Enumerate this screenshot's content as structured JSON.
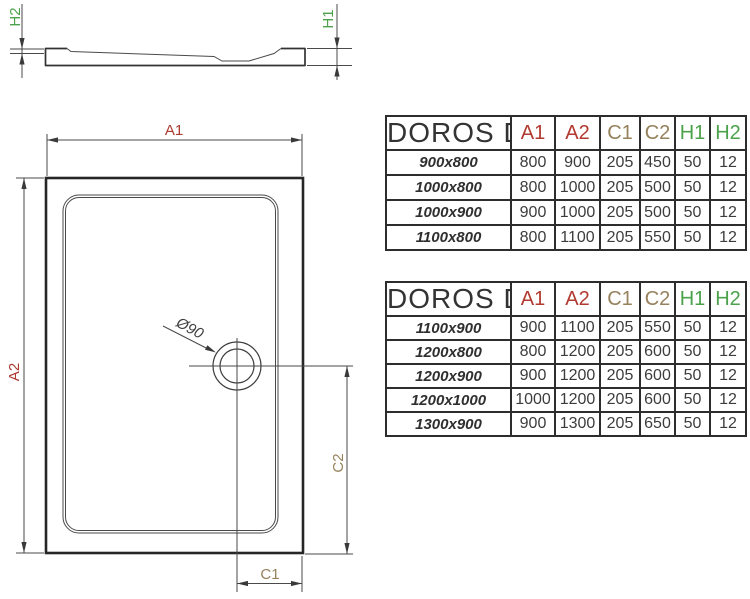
{
  "drawing": {
    "side_view": {
      "h1_label": "H1",
      "h2_label": "H2"
    },
    "top_view": {
      "a1_label": "A1",
      "a2_label": "A2",
      "c1_label": "C1",
      "c2_label": "C2",
      "drain_label": "Ø90"
    }
  },
  "colors": {
    "dimension_a": "#ab3a31",
    "dimension_c": "#96815c",
    "dimension_h": "#4ba24b",
    "line": "#3c3c3c",
    "table_border": "#2d2d2d"
  },
  "tables": [
    {
      "title": "DOROS D",
      "columns": [
        "A1",
        "A2",
        "C1",
        "C2",
        "H1",
        "H2"
      ],
      "rows": [
        {
          "size": "900x800",
          "values": [
            "800",
            "900",
            "205",
            "450",
            "50",
            "12"
          ]
        },
        {
          "size": "1000x800",
          "values": [
            "800",
            "1000",
            "205",
            "500",
            "50",
            "12"
          ]
        },
        {
          "size": "1000x900",
          "values": [
            "900",
            "1000",
            "205",
            "500",
            "50",
            "12"
          ]
        },
        {
          "size": "1100x800",
          "values": [
            "800",
            "1100",
            "205",
            "550",
            "50",
            "12"
          ]
        }
      ]
    },
    {
      "title": "DOROS D",
      "columns": [
        "A1",
        "A2",
        "C1",
        "C2",
        "H1",
        "H2"
      ],
      "rows": [
        {
          "size": "1100x900",
          "values": [
            "900",
            "1100",
            "205",
            "550",
            "50",
            "12"
          ]
        },
        {
          "size": "1200x800",
          "values": [
            "800",
            "1200",
            "205",
            "600",
            "50",
            "12"
          ]
        },
        {
          "size": "1200x900",
          "values": [
            "900",
            "1200",
            "205",
            "600",
            "50",
            "12"
          ]
        },
        {
          "size": "1200x1000",
          "values": [
            "1000",
            "1200",
            "205",
            "600",
            "50",
            "12"
          ]
        },
        {
          "size": "1300x900",
          "values": [
            "900",
            "1300",
            "205",
            "650",
            "50",
            "12"
          ]
        }
      ]
    }
  ]
}
